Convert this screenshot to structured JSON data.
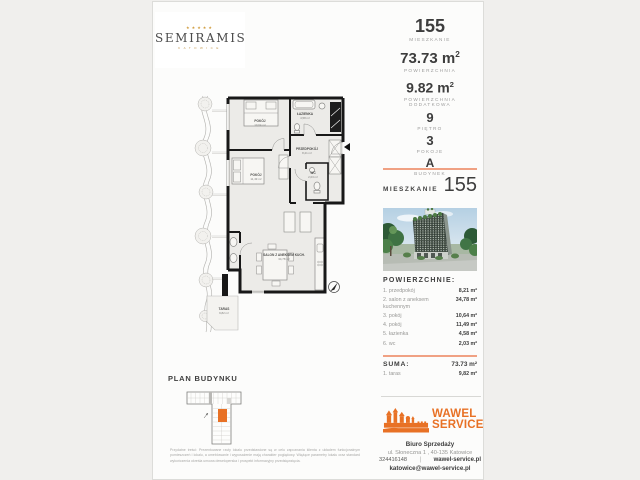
{
  "colors": {
    "accent_orange": "#e87125",
    "divider_salmon": "#f0a183",
    "wall_black": "#181818"
  },
  "logo": {
    "stars": "★★★★★",
    "name": "SEMIRAMIS",
    "city": "KATOWICE"
  },
  "summary": {
    "items": [
      {
        "value": "155",
        "sup": "",
        "label": "MIESZKANIE"
      },
      {
        "value": "73.73 m",
        "sup": "2",
        "label": "POWIERZCHNIA"
      },
      {
        "value": "9.82 m",
        "sup": "2",
        "label": "POWIERZCHNIA DODATKOWA"
      },
      {
        "value": "9",
        "sup": "",
        "label": "PIĘTRO"
      },
      {
        "value": "3",
        "sup": "",
        "label": "POKOJE"
      },
      {
        "value": "A",
        "sup": "",
        "label": "BUDYNEK"
      }
    ]
  },
  "mieszkanie_row": {
    "label": "MIESZKANIE",
    "value": "155"
  },
  "areas": {
    "heading": "POWIERZCHNIE:",
    "rows": [
      {
        "label": "1. przedpokój",
        "value": "8,21 m²"
      },
      {
        "label": "2. salon z aneksem kuchennym",
        "value": "34,78 m²"
      },
      {
        "label": "3. pokój",
        "value": "10,64 m²"
      },
      {
        "label": "4. pokój",
        "value": "11,49 m²"
      },
      {
        "label": "5. łazienka",
        "value": "4,58 m²"
      },
      {
        "label": "6. wc",
        "value": "2,03 m²"
      }
    ],
    "suma_label": "SUMA:",
    "suma_value": "73.73 m²",
    "taras_label": "1. taras",
    "taras_value": "9,82 m²"
  },
  "floor_plan": {
    "rooms": [
      {
        "name": "POKÓJ",
        "area": "10,64 m²"
      },
      {
        "name": "ŁAZIENKA",
        "area": "4,58 m²"
      },
      {
        "name": "PRZEDPOKÓJ",
        "area": "8,21 m²"
      },
      {
        "name": "POKÓJ",
        "area": "11,49 m²"
      },
      {
        "name": "WC",
        "area": "2,03 m²"
      },
      {
        "name": "SALON Z ANEKSEM KUCH.",
        "area": "34,78 m²"
      },
      {
        "name": "TARAS",
        "area": "9,82 m²"
      }
    ]
  },
  "building_plan": {
    "heading": "PLAN BUDYNKU"
  },
  "footer": {
    "brand_line1": "WAWEL",
    "brand_line2": "SERVICE",
    "office": "Biuro Sprzedaży",
    "address": "ul. Słoneczna 1 , 40-135 Katowice",
    "phone": "324416148",
    "separator": "|",
    "website": "wawel-service.pl",
    "email": "katowice@wawel-service.pl"
  },
  "disclaimer": "Przydatne treści: Prezentowane rzuty lokalu przedstawione są w celu zapoznania klienta z układem funkcjonalnym pomieszczeń i lokalu, a umeblowanie i wyposażenie mają charakter poglądowy. Wiążące parametry lokalu oraz standard wykończenia określa umowa deweloperska i prospekt informacyjny przedsięwzięcia."
}
